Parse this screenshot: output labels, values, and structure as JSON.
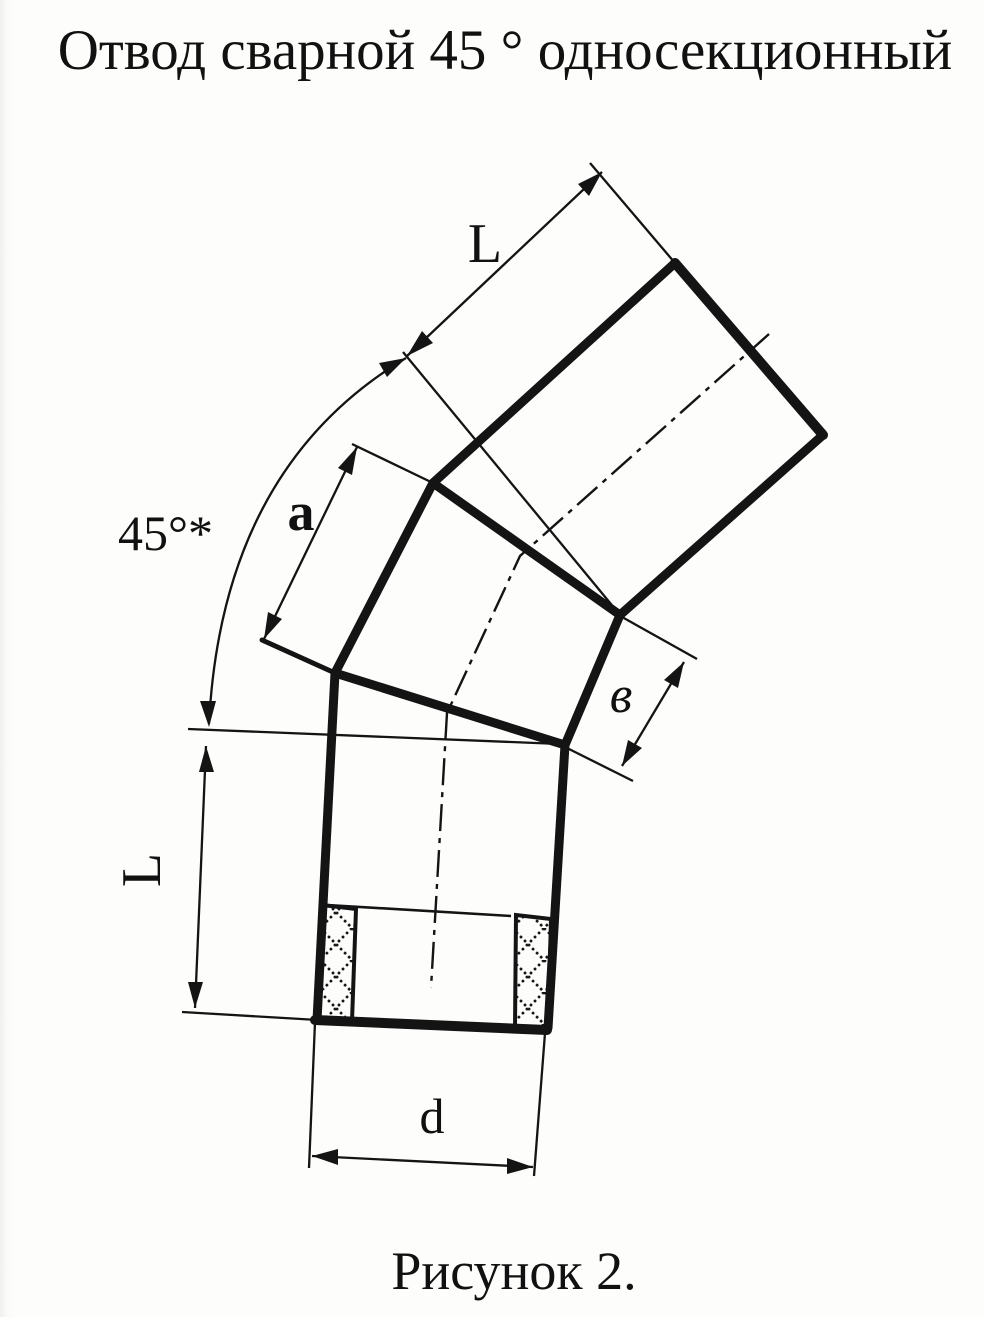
{
  "page": {
    "title": "Отвод сварной 45 ° односекционный",
    "caption": "Рисунок 2."
  },
  "figure": {
    "description": "welded 45-degree single-section pipe elbow, three pipe segments joined by two weld seams, with socket sleeve cross-section at bottom end",
    "labels": {
      "length_top": "L",
      "section_edge": "a",
      "bend_angle": "45°*",
      "joint_width": "в",
      "length_bottom": "L",
      "diameter": "d"
    }
  },
  "colors": {
    "ink": "#141414",
    "paper": "#fdfdfc"
  }
}
